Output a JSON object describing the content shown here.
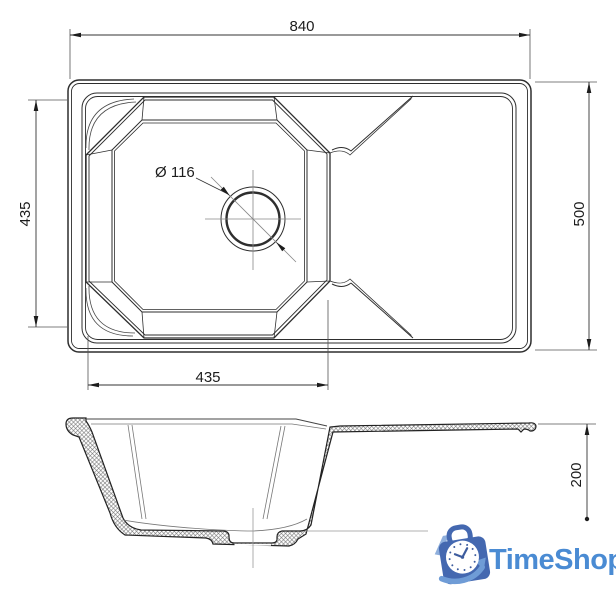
{
  "drawing": {
    "title": "kitchen sink technical drawing",
    "top_view": {
      "label": "top view",
      "dims": {
        "overall_width": "840",
        "overall_depth": "500",
        "bowl_length": "435",
        "bowl_width": "435",
        "drain_diameter": "Ø 116"
      }
    },
    "side_view": {
      "label": "section view",
      "dims": {
        "height": "200"
      }
    }
  },
  "logo": {
    "text": "TimeShop"
  },
  "colors": {
    "line": "#2e2e2e",
    "logo_text": "#4a8bd3",
    "bag": "#4468b0",
    "bag_light": "#8fafdc",
    "swoosh": "#6f9cd6",
    "clock_marks": "#3d5c9e"
  }
}
